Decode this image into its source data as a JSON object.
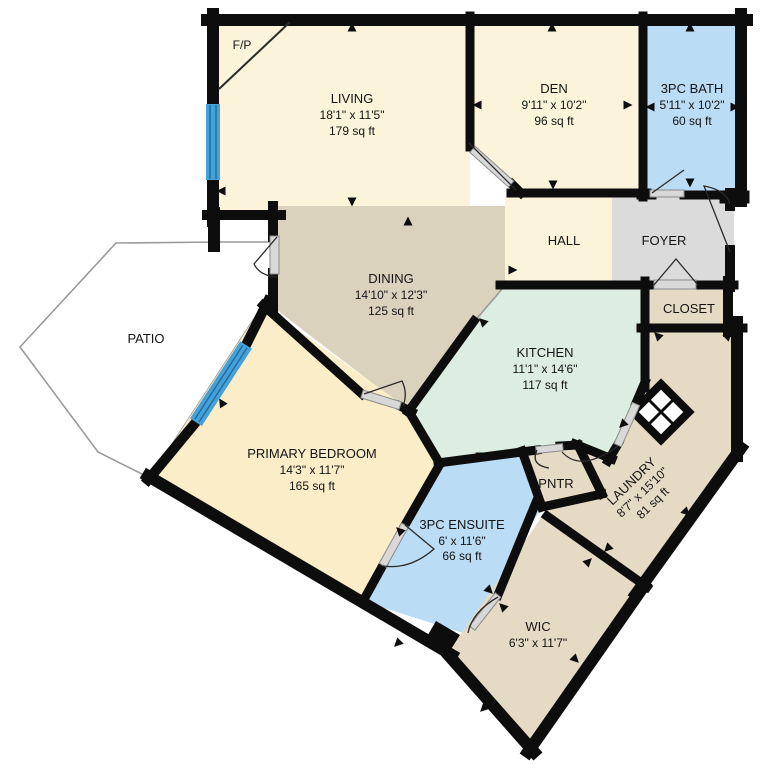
{
  "plan": {
    "type": "residential-floor-plan",
    "rooms": {
      "living": {
        "name": "LIVING",
        "dims": "18'1\" x 11'5\"",
        "area": "179 sq ft"
      },
      "den": {
        "name": "DEN",
        "dims": "9'11\" x 10'2\"",
        "area": "96 sq ft"
      },
      "bath": {
        "name": "3PC BATH",
        "dims": "5'11\" x 10'2\"",
        "area": "60 sq ft"
      },
      "hall": {
        "name": "HALL"
      },
      "foyer": {
        "name": "FOYER"
      },
      "closet": {
        "name": "CLOSET"
      },
      "dining": {
        "name": "DINING",
        "dims": "14'10\" x 12'3\"",
        "area": "125 sq ft"
      },
      "patio": {
        "name": "PATIO"
      },
      "kitchen": {
        "name": "KITCHEN",
        "dims": "11'1\" x 14'6\"",
        "area": "117 sq ft"
      },
      "primary_bedroom": {
        "name": "PRIMARY BEDROOM",
        "dims": "14'3\" x 11'7\"",
        "area": "165 sq ft"
      },
      "pantry": {
        "name": "PNTR"
      },
      "laundry": {
        "name": "LAUNDRY",
        "dims": "8'7\" x 15'10\"",
        "area": "81 sq ft"
      },
      "ensuite": {
        "name": "3PC ENSUITE",
        "dims": "6' x 11'6\"",
        "area": "66 sq ft"
      },
      "wic": {
        "name": "WIC",
        "dims": "6'3\" x 11'7\""
      },
      "fireplace": {
        "name": "F/P"
      }
    },
    "colors": {
      "cream": "#FBF4DB",
      "tan": "#DBD2BE",
      "beige": "#E5DBC5",
      "mint": "#DCEDE2",
      "blue": "#BADCF4",
      "peach": "#FBEDC8",
      "gray": "#DBDBDB",
      "white": "#FFFFFF",
      "wall": "#0D0D0D",
      "window": "#47A1D6",
      "window_stripe": "#1A6FA8",
      "door_leaf": "#D8D8D8"
    }
  }
}
